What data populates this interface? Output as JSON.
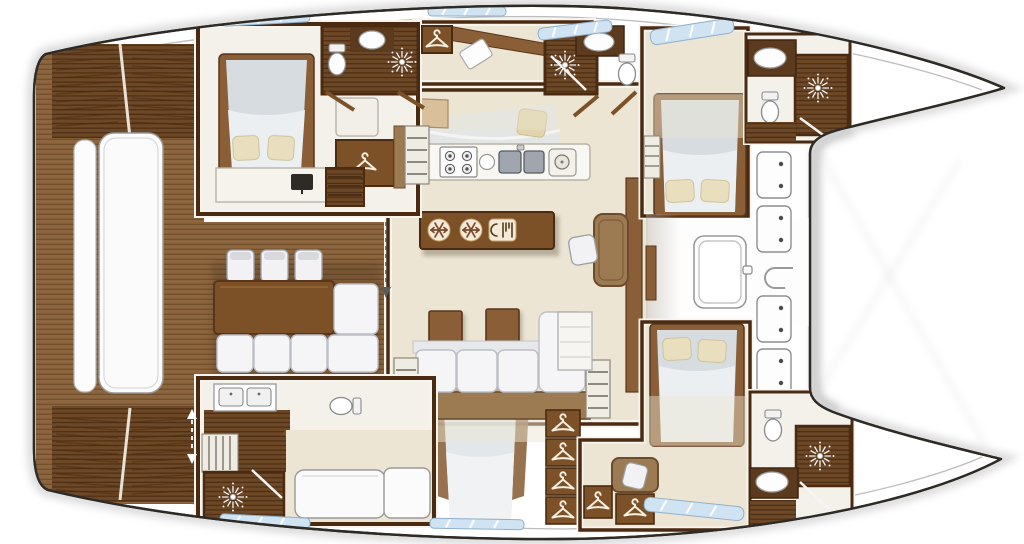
{
  "diagram": {
    "subject": "catamaran-yacht-interior-floor-plan",
    "view": "overhead-deck-plan",
    "background": "#ffffff"
  },
  "palette": {
    "outline": "#2e2b27",
    "hull_white": "#ffffff",
    "shadow": "#c9c9c9",
    "teak_base": "#8d6640",
    "teak_stripe": "#73512c",
    "teak_dark_base": "#6d4826",
    "teak_dark_stripe": "#4f2f15",
    "wall_wood": "#4a2b12",
    "furniture_wood": "#7c5128",
    "furniture_wood_edge": "#59351a",
    "furniture_wood_light": "#9c7a52",
    "furniture_wood_light_edge": "#6b4c2e",
    "vanity_wood": "#5b3a1d",
    "counter_white": "#f9f7f2",
    "floor_beige": "#ece5d3",
    "floor_white": "#f4f1ea",
    "landing_wood": "#d9c09a",
    "mattress": "#d6dce0",
    "sheet": "#eceff1",
    "pillow": "#e9dfbe",
    "pillow_edge": "#cfc49c",
    "upholstery": "#f5f5f7",
    "upholstery_edge": "#bcbfc5",
    "fixture_white": "#fdfdfd",
    "fixture_edge": "#8e8e8e",
    "window_glass": "#cfe3f2",
    "window_frame": "#8fb0c9",
    "icon_cream": "#f3ead8",
    "icon_brown": "#7a4a2b",
    "icon_white": "#f5efe2",
    "sink_steel": "#9fa6ad",
    "arrow_gray": "#5a5a5a"
  },
  "icons": [
    "hanger-icon",
    "shower-sunburst-icon",
    "snowflake-icon",
    "cutlery-icon",
    "stove-burner-icon",
    "deck-hatch-icon",
    "skylight-hatch-icon",
    "companionway-arrow-icon",
    "toilet-icon",
    "sink-icon",
    "tv-icon"
  ],
  "rooms": [
    {
      "name": "aft-cockpit",
      "items": [
        "teak-deck",
        "transom-stairs-port",
        "transom-stairs-starboard",
        "sunpad-bench",
        "dining-table",
        "three-chairs",
        "l-shaped-sofa"
      ]
    },
    {
      "name": "salon",
      "items": [
        "sofa",
        "two-ottomans",
        "wet-bar-island",
        "fridge-icons",
        "cutlery-icon",
        "nav-desk",
        "chair",
        "tv-cabinet",
        "companionway-stairs"
      ]
    },
    {
      "name": "galley",
      "items": [
        "four-burner-stove",
        "round-sink",
        "double-sink",
        "appliance",
        "prep-counter"
      ]
    },
    {
      "name": "port-aft-cabin",
      "items": [
        "double-bed",
        "pillows",
        "dresser",
        "tv",
        "wardrobe",
        "stairs"
      ]
    },
    {
      "name": "port-aft-bathroom",
      "items": [
        "toilet",
        "sink",
        "shower"
      ]
    },
    {
      "name": "port-mid-bathroom",
      "items": [
        "toilet",
        "sink",
        "shower",
        "wardrobe"
      ]
    },
    {
      "name": "port-forward-cabin",
      "items": [
        "double-bed",
        "pillows",
        "stairs"
      ]
    },
    {
      "name": "port-forward-bathroom",
      "items": [
        "toilet",
        "sink",
        "shower"
      ]
    },
    {
      "name": "starboard-aft-bathroom",
      "items": [
        "double-vanity",
        "toilet",
        "shower",
        "ladder"
      ]
    },
    {
      "name": "starboard-aft-cabin",
      "items": [
        "single-berth",
        "seat"
      ]
    },
    {
      "name": "master-cabin-below",
      "items": [
        "double-bed-ghosted",
        "wardrobe-column"
      ]
    },
    {
      "name": "starboard-forward-cabin",
      "items": [
        "double-bed",
        "pillows",
        "vanity-desk",
        "stool",
        "wardrobes"
      ]
    },
    {
      "name": "starboard-forward-bathroom",
      "items": [
        "toilet",
        "sink",
        "shower"
      ]
    },
    {
      "name": "foredeck",
      "items": [
        "skylight-hatch",
        "four-deck-hatches",
        "anchor-fitting"
      ]
    }
  ],
  "counts": {
    "showers": 5,
    "toilets": 5,
    "beds": 5,
    "deck_hatches": 4,
    "hanger_wardrobes": 8,
    "window_strips": 7
  }
}
